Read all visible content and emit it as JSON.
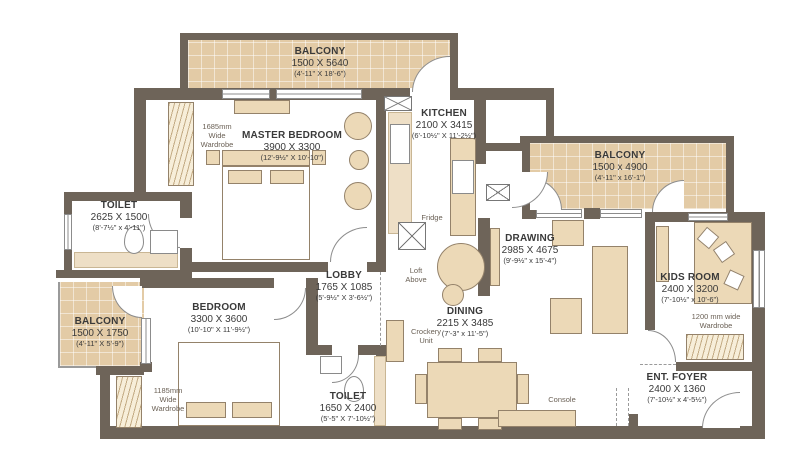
{
  "plan": {
    "title": "apartment-floor-plan",
    "rooms": [
      {
        "id": "balcony-top",
        "name": "BALCONY",
        "mm": "1500 X 5640",
        "ft": "(4'-11\" X 18'-6\")"
      },
      {
        "id": "master-bedroom",
        "name": "MASTER BEDROOM",
        "mm": "3900 X 3300",
        "ft": "(12'-9½\" X 10'-10\")"
      },
      {
        "id": "toilet-left",
        "name": "TOILET",
        "mm": "2625 X 1500",
        "ft": "(8'-7½\" x 4'-11\")"
      },
      {
        "id": "balcony-left",
        "name": "BALCONY",
        "mm": "1500 X 1750",
        "ft": "(4'-11\" X 5'-9\")"
      },
      {
        "id": "bedroom",
        "name": "BEDROOM",
        "mm": "3300 X 3600",
        "ft": "(10'-10\" X 11'-9½\")"
      },
      {
        "id": "lobby",
        "name": "LOBBY",
        "mm": "1765 X 1085",
        "ft": "(5'-9½\" X 3'-6½\")"
      },
      {
        "id": "kitchen",
        "name": "KITCHEN",
        "mm": "2100 X 3415",
        "ft": "(6'-10½\" X 11'-2½\")"
      },
      {
        "id": "toilet-bottom",
        "name": "TOILET",
        "mm": "1650 X 2400",
        "ft": "(5'-5\" X 7'-10½\")"
      },
      {
        "id": "dining",
        "name": "DINING",
        "mm": "2215 X 3485",
        "ft": "(7'-3\" x 11'-5\")"
      },
      {
        "id": "drawing",
        "name": "DRAWING",
        "mm": "2985 X 4675",
        "ft": "(9'-9½\" x 15'-4\")"
      },
      {
        "id": "balcony-right",
        "name": "BALCONY",
        "mm": "1500 x 4900",
        "ft": "(4'-11\" x 16'-1\")"
      },
      {
        "id": "kids-room",
        "name": "KIDS ROOM",
        "mm": "2400 X 3200",
        "ft": "(7'-10½\" x 10'-6\")"
      },
      {
        "id": "ent-foyer",
        "name": "ENT. FOYER",
        "mm": "2400 X 1360",
        "ft": "(7'-10½\" x 4'-5½\")"
      }
    ],
    "annotations": {
      "wardrobe_master": "1685mm\nWide\nWardrobe",
      "wardrobe_bedroom": "1185mm\nWide\nWardrobe",
      "wardrobe_kids": "1200 mm wide\nWardrobe",
      "fridge": "Fridge",
      "loft": "Loft\nAbove",
      "crockery": "Crockery\nUnit",
      "console": "Console"
    },
    "colors": {
      "wall": "#6e6459",
      "balcony_floor": "#e3cba6",
      "furniture": "#ecd9b7",
      "furniture_border": "#94826a",
      "text": "#3a3a3a",
      "annotation_text": "#6b6156"
    }
  }
}
